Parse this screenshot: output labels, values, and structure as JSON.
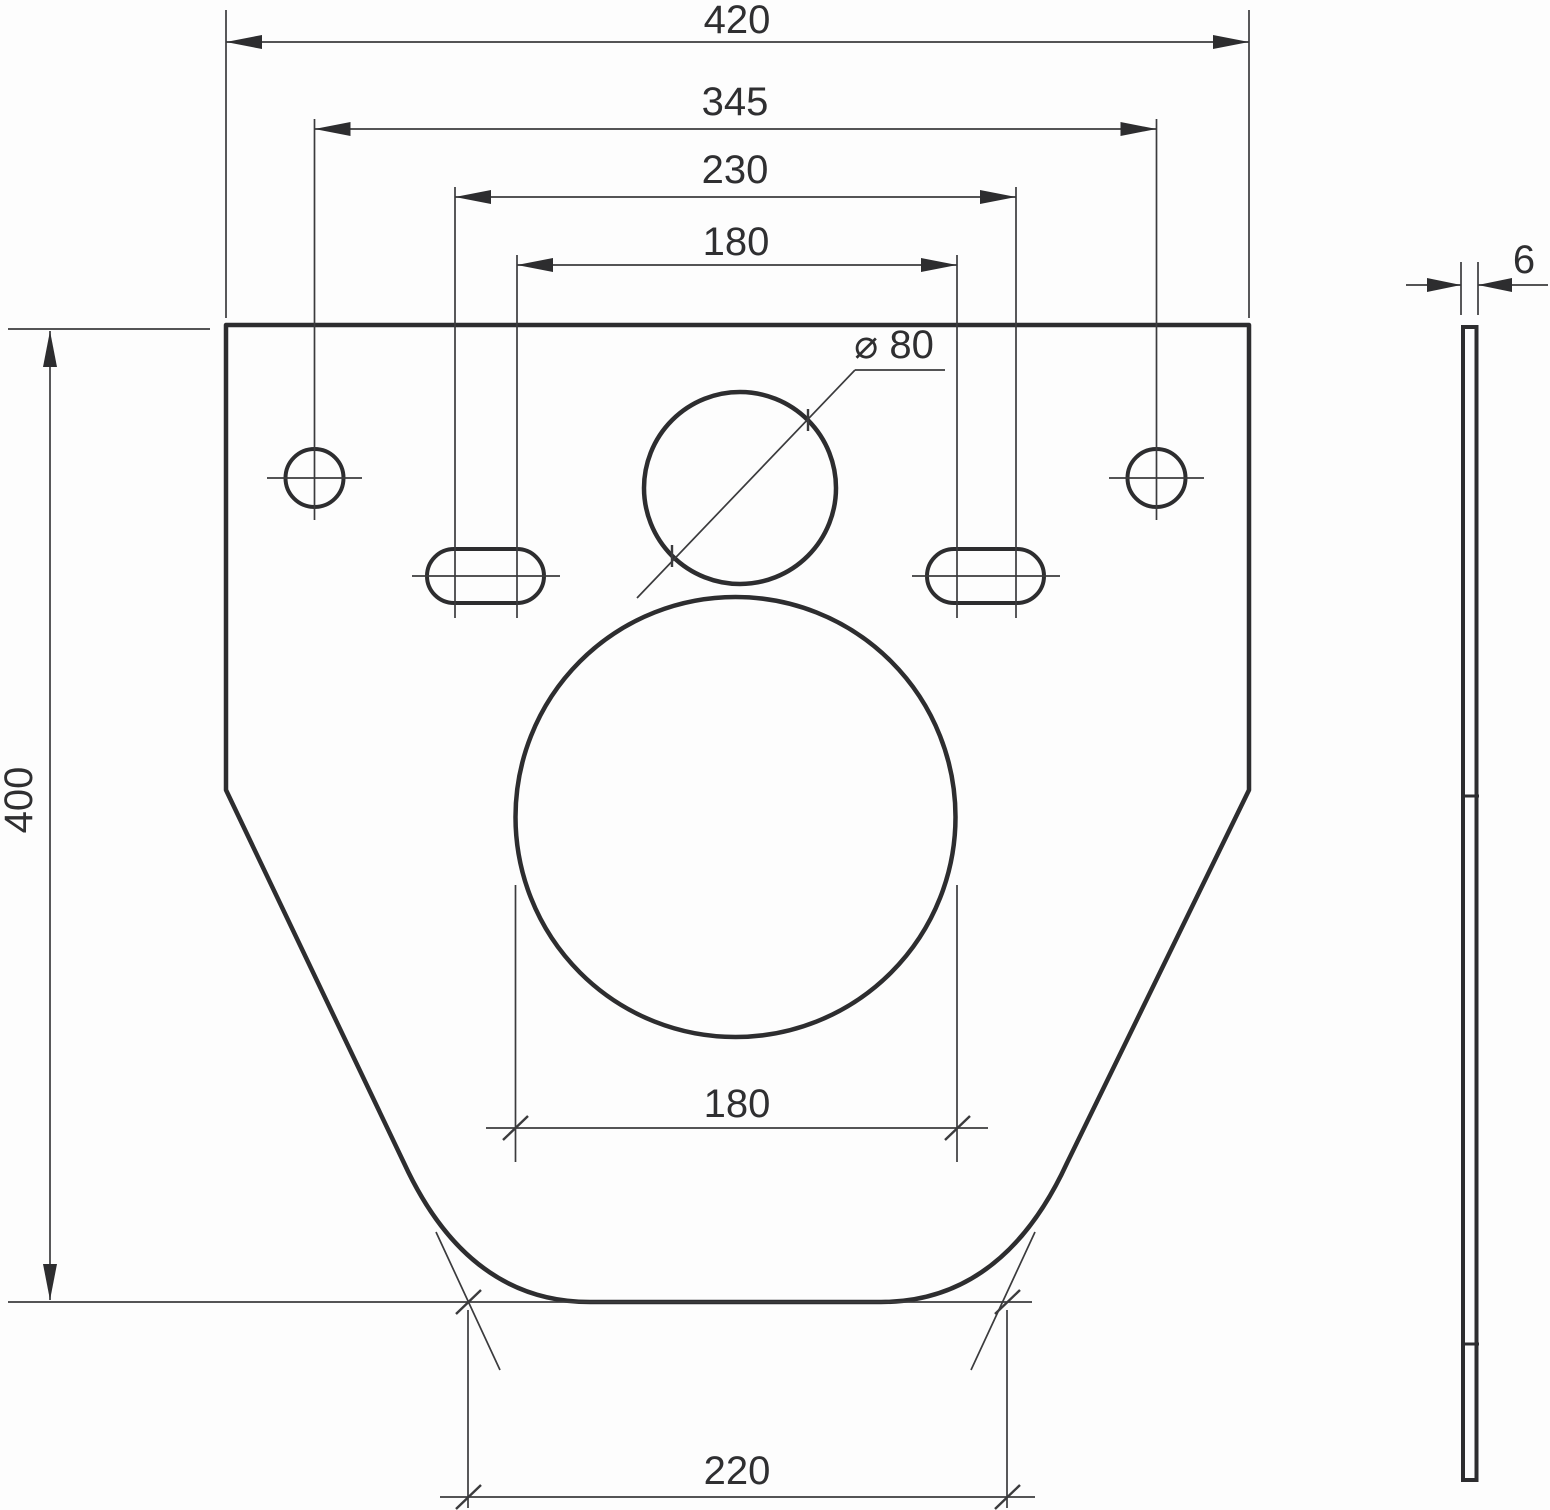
{
  "drawing": {
    "description": "Dimensioned two-view technical drawing of a flat mounting/insulation plate with holes",
    "units_implied": "mm",
    "dims": {
      "overall_width": "420",
      "hole_spacing_345": "345",
      "hole_spacing_230": "230",
      "hole_spacing_180": "180",
      "height_400": "400",
      "dia_80": "⌀ 80",
      "circle_dia_180": "180",
      "bottom_width_220": "220",
      "thickness_6": "6"
    },
    "features": {
      "front_view": "trapezoidal plate, straight top, vertical sides, tapered lower sides, rounded flat bottom",
      "holes": "2 round fixing holes, 2 obround slots, 1 circle dia 80, 1 large circle dia 180",
      "side_view": "thin vertical strip, thickness 6, two break joints"
    }
  }
}
